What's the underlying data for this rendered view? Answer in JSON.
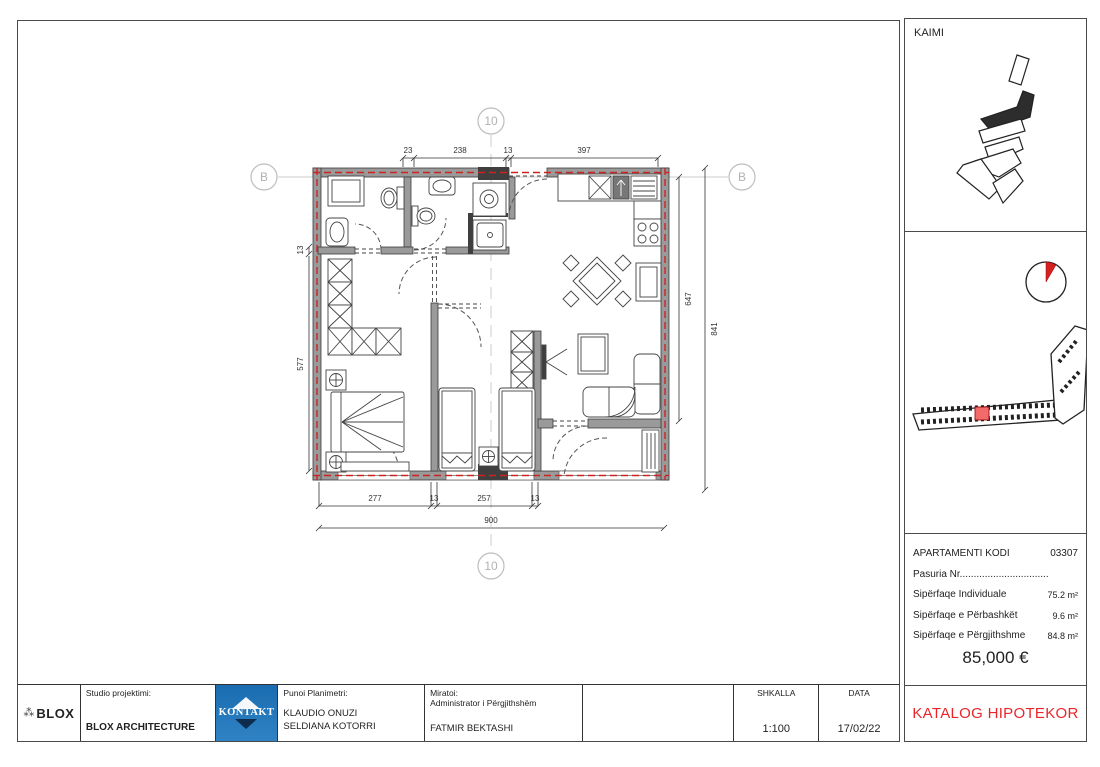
{
  "colors": {
    "red_accent": "#e8262a",
    "red_dash": "#cc2222",
    "wall_gray": "#9a9a9a",
    "kontakt_blue": "#1a6cb0",
    "site_highlight": "#f26a6a"
  },
  "sidebar": {
    "kaimi_label": "KAIMI",
    "apartment": {
      "kodi_label": "APARTAMENTI KODI",
      "kodi_value": "03307",
      "pasuria_line": "Pasuria Nr................................",
      "rows": [
        {
          "label": "Sipërfaqe Individuale",
          "value": "75.2 m²"
        },
        {
          "label": "Sipërfaqe e Përbashkët",
          "value": "9.6 m²"
        },
        {
          "label": "Sipërfaqe e Përgjithshme",
          "value": "84.8 m²"
        }
      ],
      "price": "85,000 €"
    },
    "catalog_label": "KATALOG HIPOTEKOR"
  },
  "titleblock": {
    "blox_logo": "BLOX",
    "blox_icon": "⁂",
    "studio_label": "Studio projektimi:",
    "studio_value": "BLOX ARCHITECTURE",
    "kontakt_logo": "KONTAKT",
    "punoi_label": "Punoi Planimetri:",
    "punoi_name1": "KLAUDIO ONUZI",
    "punoi_name2": "SELDIANA KOTORRI",
    "miratoi_label": "Miratoi:",
    "miratoi_role": "Administrator i Përgjithshëm",
    "miratoi_name": "FATMIR BEKTASHI",
    "shkalla_label": "SHKALLA",
    "shkalla_value": "1:100",
    "data_label": "DATA",
    "data_value": "17/02/22"
  },
  "plan": {
    "grid": {
      "b": "B",
      "ten": "10"
    },
    "dims": {
      "top": [
        "23",
        "238",
        "13",
        "397"
      ],
      "bottom": [
        "277",
        "13",
        "257",
        "13"
      ],
      "total": "900",
      "left": [
        "13",
        "577"
      ],
      "right": [
        "647",
        "841"
      ]
    }
  }
}
